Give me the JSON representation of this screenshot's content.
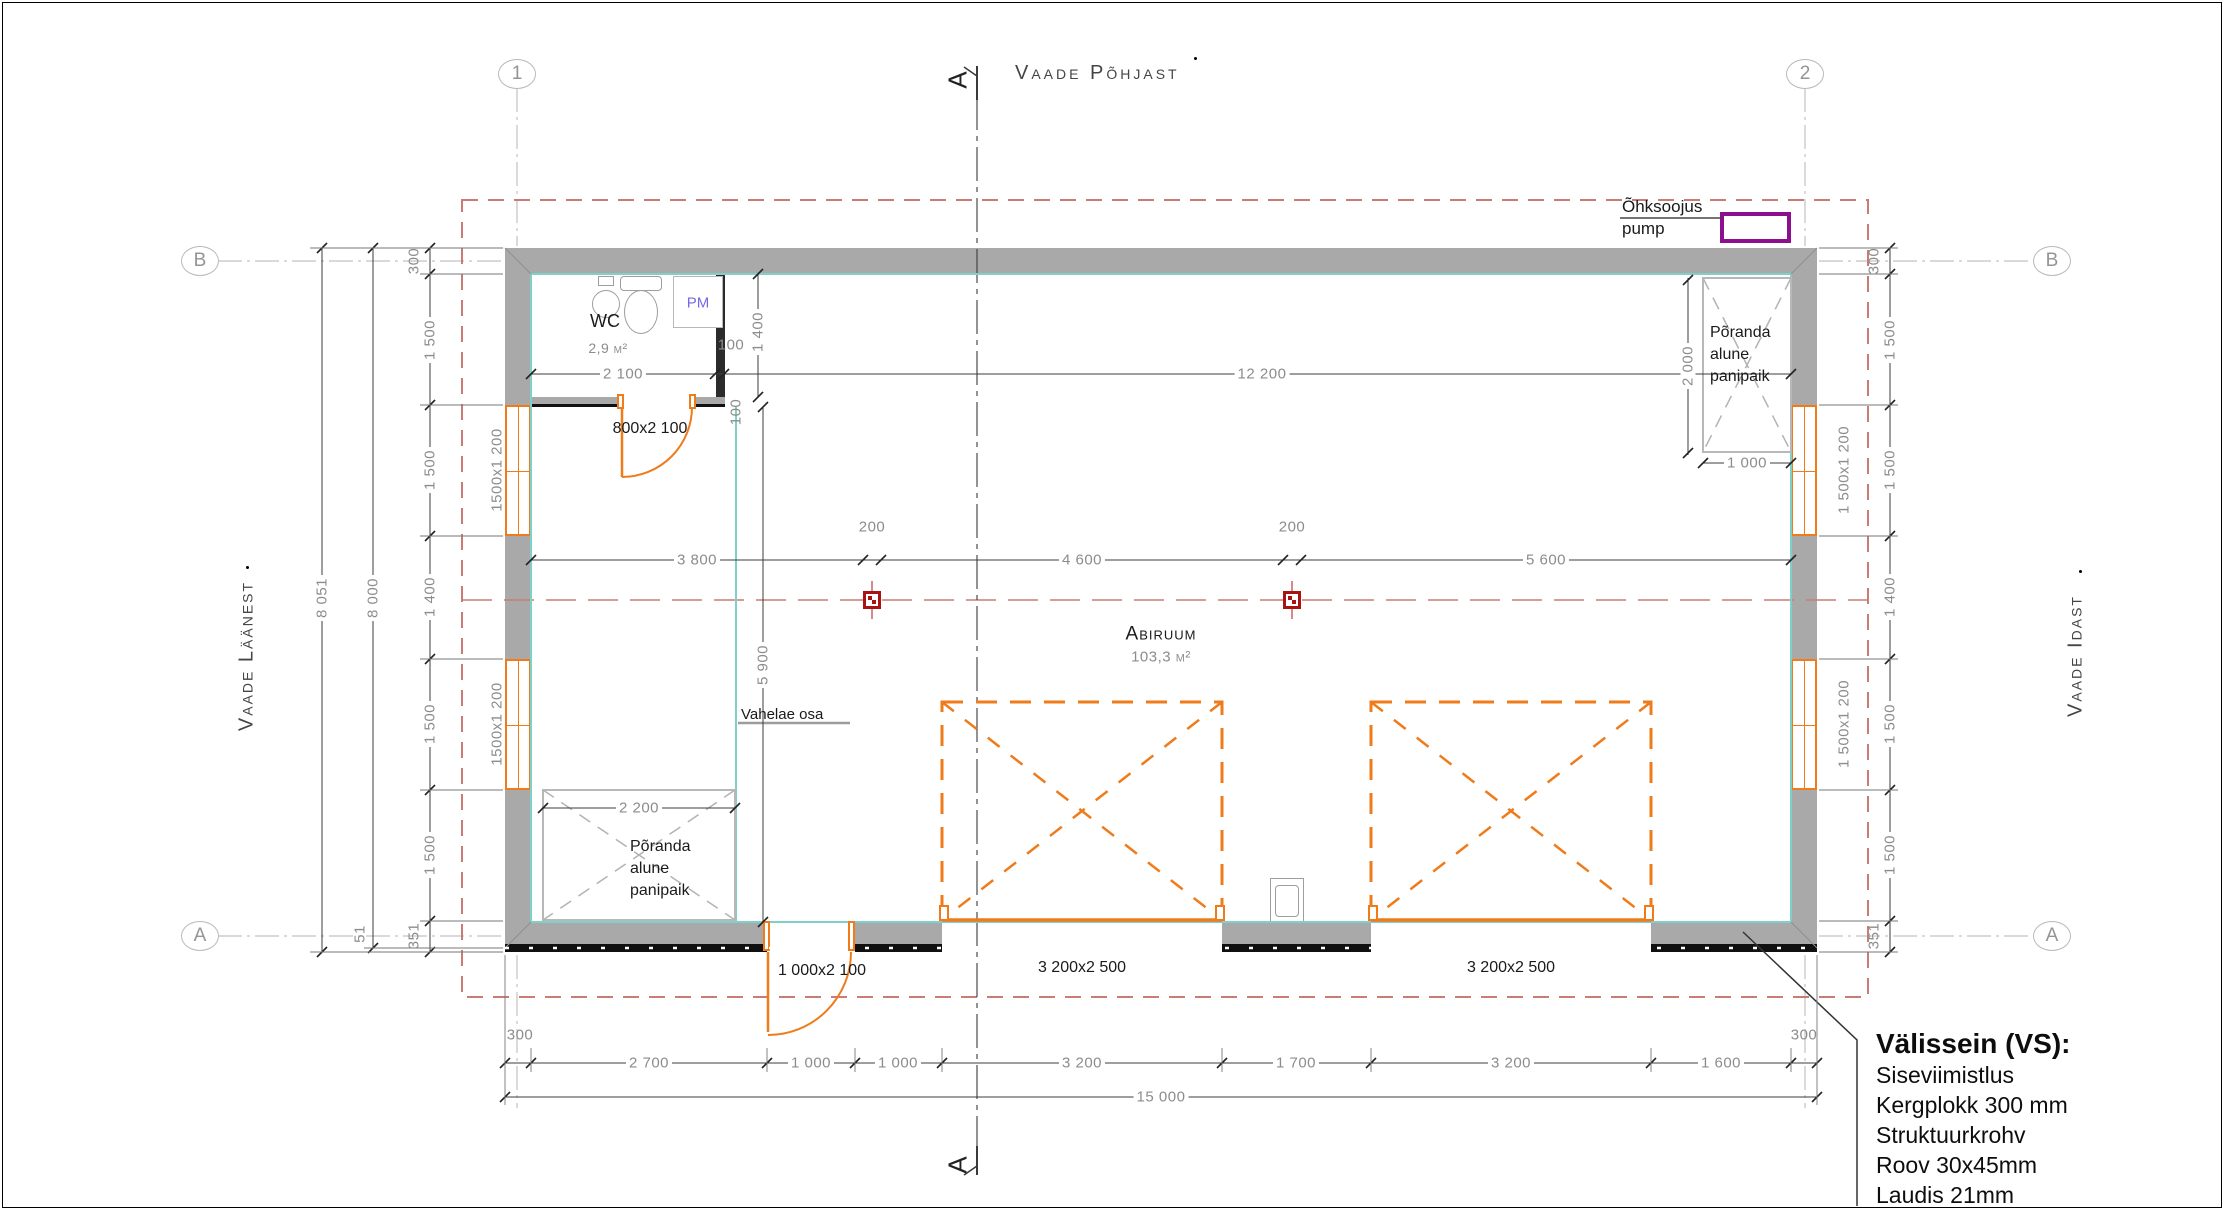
{
  "views": {
    "north": "Vaade Põhjast",
    "west": "Vaade Läänest",
    "east": "Vaade Idast"
  },
  "grid": {
    "col1": "1",
    "col2": "2",
    "rowA": "A",
    "rowB": "B"
  },
  "section_marker": "A",
  "pump_label": {
    "line1": "Õhksoojus",
    "line2": "pump"
  },
  "rooms": {
    "wc": {
      "name": "WC",
      "area": "2,9 m²"
    },
    "abiruum": {
      "name": "Abiruum",
      "area": "103,3 m²"
    },
    "pm": "PM",
    "vahelae": "Vahelae osa",
    "storage_top": {
      "l1": "Põranda",
      "l2": "alune",
      "l3": "panipaik"
    },
    "storage_bottom": {
      "l1": "Põranda",
      "l2": "alune",
      "l3": "panipaik"
    }
  },
  "doors": {
    "wc": "800x2 100",
    "entry": "1 000x2 100",
    "garage1": "3 200x2 500",
    "garage2": "3 200x2 500"
  },
  "windows": {
    "left1": "1500x1 200",
    "left2": "1500x1 200",
    "right1": "1 500x1 200",
    "right2": "1 500x1 200"
  },
  "dims": {
    "top": {
      "wc_w": "2 100",
      "wc_wall": "100",
      "wc_h": "1 400",
      "door_wall": "100",
      "main": "12 200",
      "storage_h": "2 000",
      "storage_w": "1 000"
    },
    "mid": {
      "a": "3 800",
      "p1": "200",
      "b": "4 600",
      "p2": "200",
      "c": "5 600",
      "h": "5 900",
      "storage_w": "2 200"
    },
    "bottom": {
      "chain": [
        "300",
        "2 700",
        "1 000",
        "1 000",
        "3 200",
        "1 700",
        "3 200",
        "1 600",
        "300"
      ],
      "total": "15 000"
    },
    "left": {
      "overall": "8 051",
      "extra": "51",
      "inner": "8 000",
      "chain": [
        "300",
        "1 500",
        "1 500",
        "1 400",
        "1 500",
        "1 500",
        "351"
      ]
    },
    "right": {
      "chain": [
        "300",
        "1 500",
        "1 500",
        "1 400",
        "1 500",
        "1 500",
        "351"
      ]
    }
  },
  "note": {
    "title": "Välissein (VS):",
    "lines": [
      "Siseviimistlus",
      "Kergplokk 300 mm",
      "Struktuurkrohv",
      "Roov 30x45mm",
      "Laudis 21mm"
    ]
  },
  "colors": {
    "orange": "#ef7b1a",
    "wall_gray": "#a9a9a9",
    "boundary_red": "#c97c74",
    "teal": "#7fd0c8",
    "pump_purple": "#8b0f8f",
    "post_red": "#a81414",
    "dim_gray": "#8c8c8c"
  }
}
